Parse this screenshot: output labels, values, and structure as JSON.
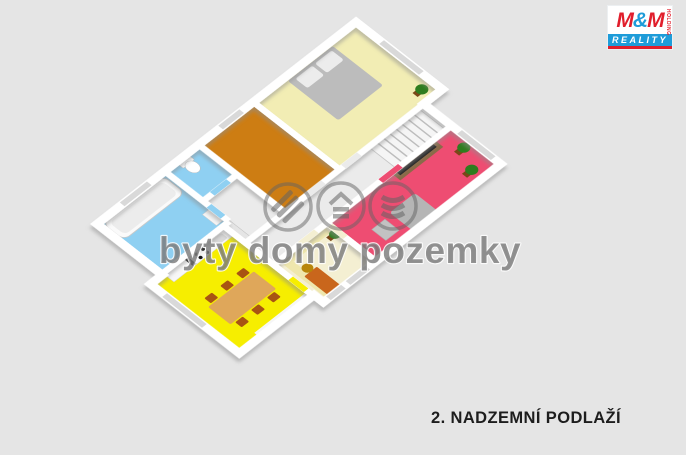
{
  "page": {
    "background": "#e5e5e5"
  },
  "caption": {
    "floor_label": "2. NADZEMNÍ PODLAŽÍ"
  },
  "watermark": {
    "text": "byty domy pozemky"
  },
  "logo": {
    "m_left": "M",
    "ampersand": "&",
    "m_right": "M",
    "reality": "REALITY",
    "holding": "HOLDING",
    "red": "#e11e2c",
    "blue": "#1e9cd9"
  },
  "floorplan": {
    "wall_color": "#ffffff",
    "hall_color": "#ebebeb",
    "stairs_color": "#f5f5f5",
    "window_color": "#d9d9d9",
    "rooms": {
      "bedroom": {
        "color": "#f2edb4"
      },
      "orange_room": {
        "color": "#cd7d13"
      },
      "wc": {
        "color": "#8fd0f2"
      },
      "bathroom": {
        "color": "#8fd0f2"
      },
      "living_room": {
        "color": "#ee4d72"
      },
      "study": {
        "color": "#f4efd2"
      },
      "kitchen": {
        "color": "#f6ee00"
      }
    },
    "furniture": {
      "bed": "#bcbcbc",
      "pillow": "#ececec",
      "bathtub": "#fafafa",
      "tub_inner": "#ececec",
      "toilet": "#ffffff",
      "sink": "#f5f5f5",
      "tv": "#1b1b1b",
      "tv_stand": "#8a6a48",
      "armchair": "#b5b5b5",
      "side_table": "#c2c2c2",
      "dining_table": "#dfa75a",
      "dining_chair": "#a85413",
      "counter": "#f7f7f7",
      "burner": "#151515",
      "desk": "#c9661c",
      "desk_chair": "#b8860b",
      "bench": "#efe7ad",
      "plant": "#2e7d1e",
      "pot": "#7a4718"
    }
  }
}
